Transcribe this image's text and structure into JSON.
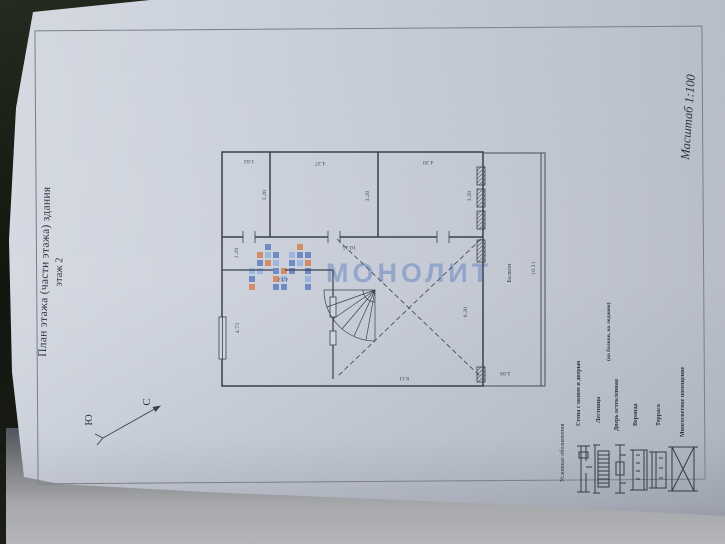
{
  "sheet": {
    "title_line1": "План этажа (части этажа) здания",
    "title_line2": "этаж 2",
    "scale_note": "Масштаб 1:100",
    "compass_north": "С",
    "compass_south": "Ю",
    "watermark_text": "МОНОЛИТ"
  },
  "plan": {
    "balcony_label": "Балкон",
    "dims": {
      "room1_width": "1.62",
      "room2_width": "4.27",
      "room3_width": "4.20",
      "room1_depth": "3.20",
      "room2_depth": "3.20",
      "room3_depth": "3.20",
      "inner_width": "10.45",
      "corridor_depth": "1.29",
      "room4_width": "4.12",
      "room4_depth": "4.73",
      "hall_depth": "6.20",
      "hall_width": "8.11",
      "balcony_length": "10.21",
      "balcony_width": "2.66"
    }
  },
  "legend": {
    "heading": "Условные обозначения",
    "items": [
      {
        "label": "Стена с окном и дверью",
        "icon": "wall-window-door"
      },
      {
        "label": "Лестница",
        "icon": "stairs"
      },
      {
        "label": "Дверь остекленная",
        "label2": "(на балкон, на лоджию)",
        "icon": "glazed-door"
      },
      {
        "label": "Веранда",
        "icon": "veranda"
      },
      {
        "label": "Терраса",
        "icon": "terrace"
      },
      {
        "label": "Многосветное помещение",
        "icon": "multi-light-room"
      }
    ]
  },
  "colors": {
    "paper": "#ccd1db",
    "ink": "#39404e",
    "watermark_blue": "#6888c2",
    "mosaic_orange": "#d9814e",
    "mosaic_blue": "#5d7fc4",
    "mosaic_light": "#93b2e0"
  }
}
